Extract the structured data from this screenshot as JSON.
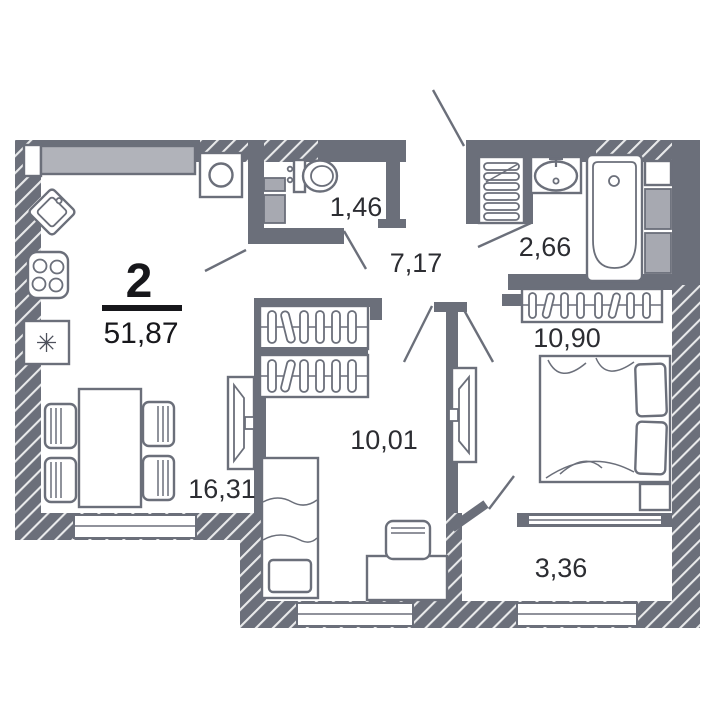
{
  "plan_card": {
    "rooms_count_label": "2",
    "total_area_label": "51,87"
  },
  "rooms": [
    {
      "name": "kitchen-living-room",
      "area_label": "16,31"
    },
    {
      "name": "hallway",
      "area_label": "7,17"
    },
    {
      "name": "toilet",
      "area_label": "1,46"
    },
    {
      "name": "bathroom",
      "area_label": "2,66"
    },
    {
      "name": "bedroom",
      "area_label": "10,90"
    },
    {
      "name": "children-room",
      "area_label": "10,01"
    },
    {
      "name": "balcony",
      "area_label": "3,36"
    }
  ],
  "icons": {
    "fridge_snowflake": "✳"
  },
  "colors": {
    "wall": "#6b6f7a",
    "counter_fill": "#b1b3ba",
    "shaft_fill": "#a7a9b1",
    "label_text": "#2c2d32",
    "accent_text": "#17171b",
    "background": "#ffffff"
  }
}
